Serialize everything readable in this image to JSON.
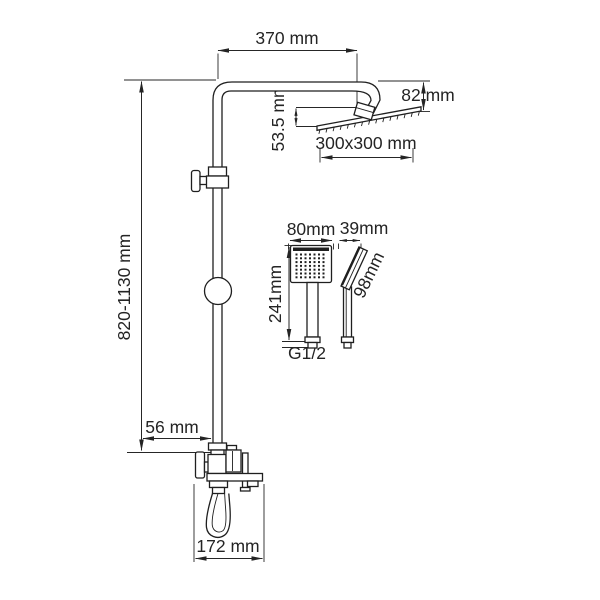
{
  "drawing": {
    "title": "Shower system dimensional drawing",
    "background_color": "#ffffff",
    "line_color": "#1f1f1f",
    "text_color": "#242424",
    "dimensions": {
      "arm_reach": "370 mm",
      "head_offset_height": "82 mm",
      "head_assembly_height": "53.5 mm",
      "head_size": "300x300 mm",
      "column_height_range": "820-1130 mm",
      "hand_shower_width": "80mm",
      "hand_shower_depth": "39mm",
      "hand_shower_length": "241mm",
      "hand_shower_head_length": "98mm",
      "connection_thread": "G1/2",
      "wall_to_pipe_offset": "56 mm",
      "spout_projection": "172 mm"
    }
  }
}
